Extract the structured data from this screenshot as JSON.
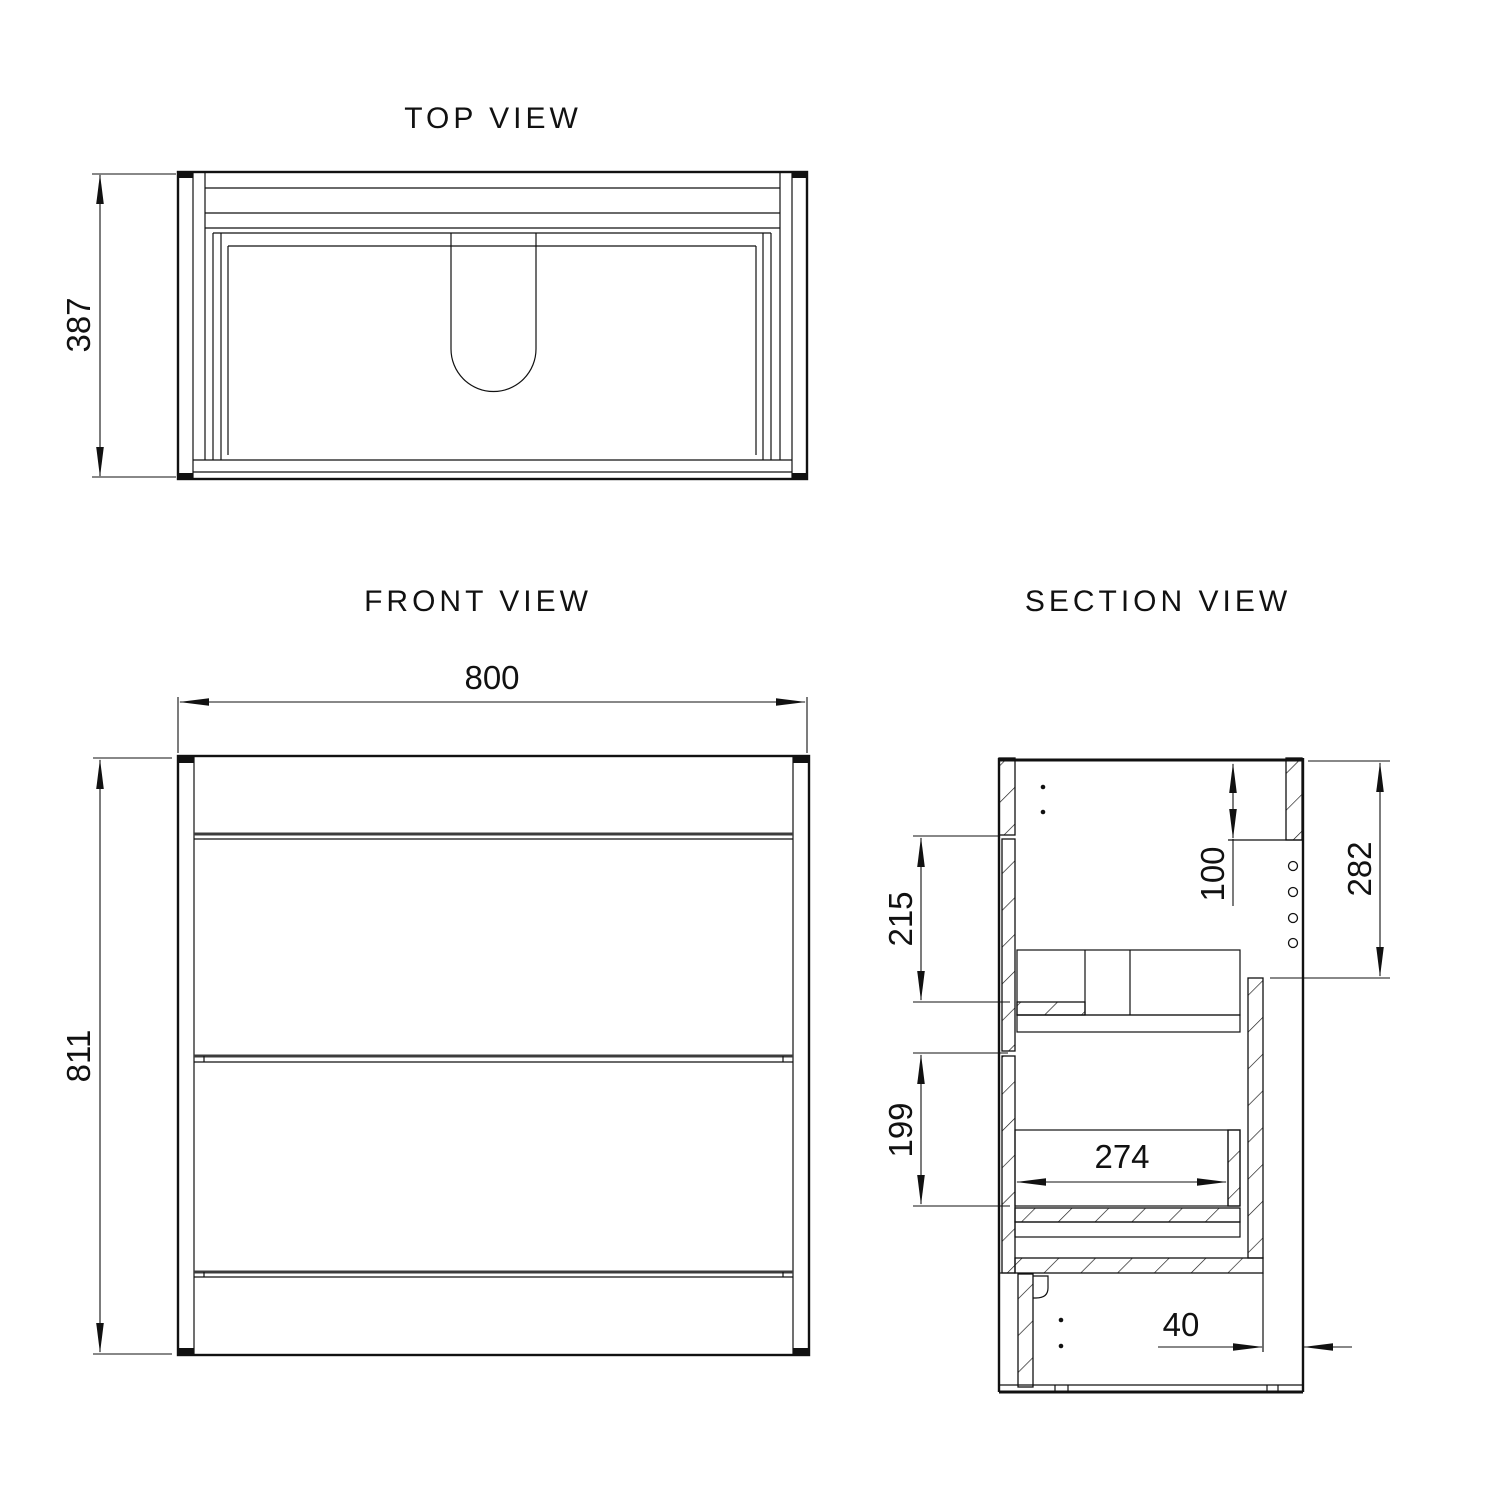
{
  "drawing": {
    "type": "cabinet-vanity-technical-drawing",
    "line_color": "#111111",
    "background": "#ffffff",
    "views": {
      "top": {
        "title": "TOP VIEW",
        "depth_label": "387"
      },
      "front": {
        "title": "FRONT VIEW",
        "width_label": "800",
        "height_label": "811"
      },
      "section": {
        "title": "SECTION VIEW",
        "top_thickness_label": "100",
        "cavity_height_label": "282",
        "upper_opening_label": "215",
        "lower_opening_label": "199",
        "drawer_depth_label": "274",
        "service_gap_label": "40"
      }
    }
  }
}
